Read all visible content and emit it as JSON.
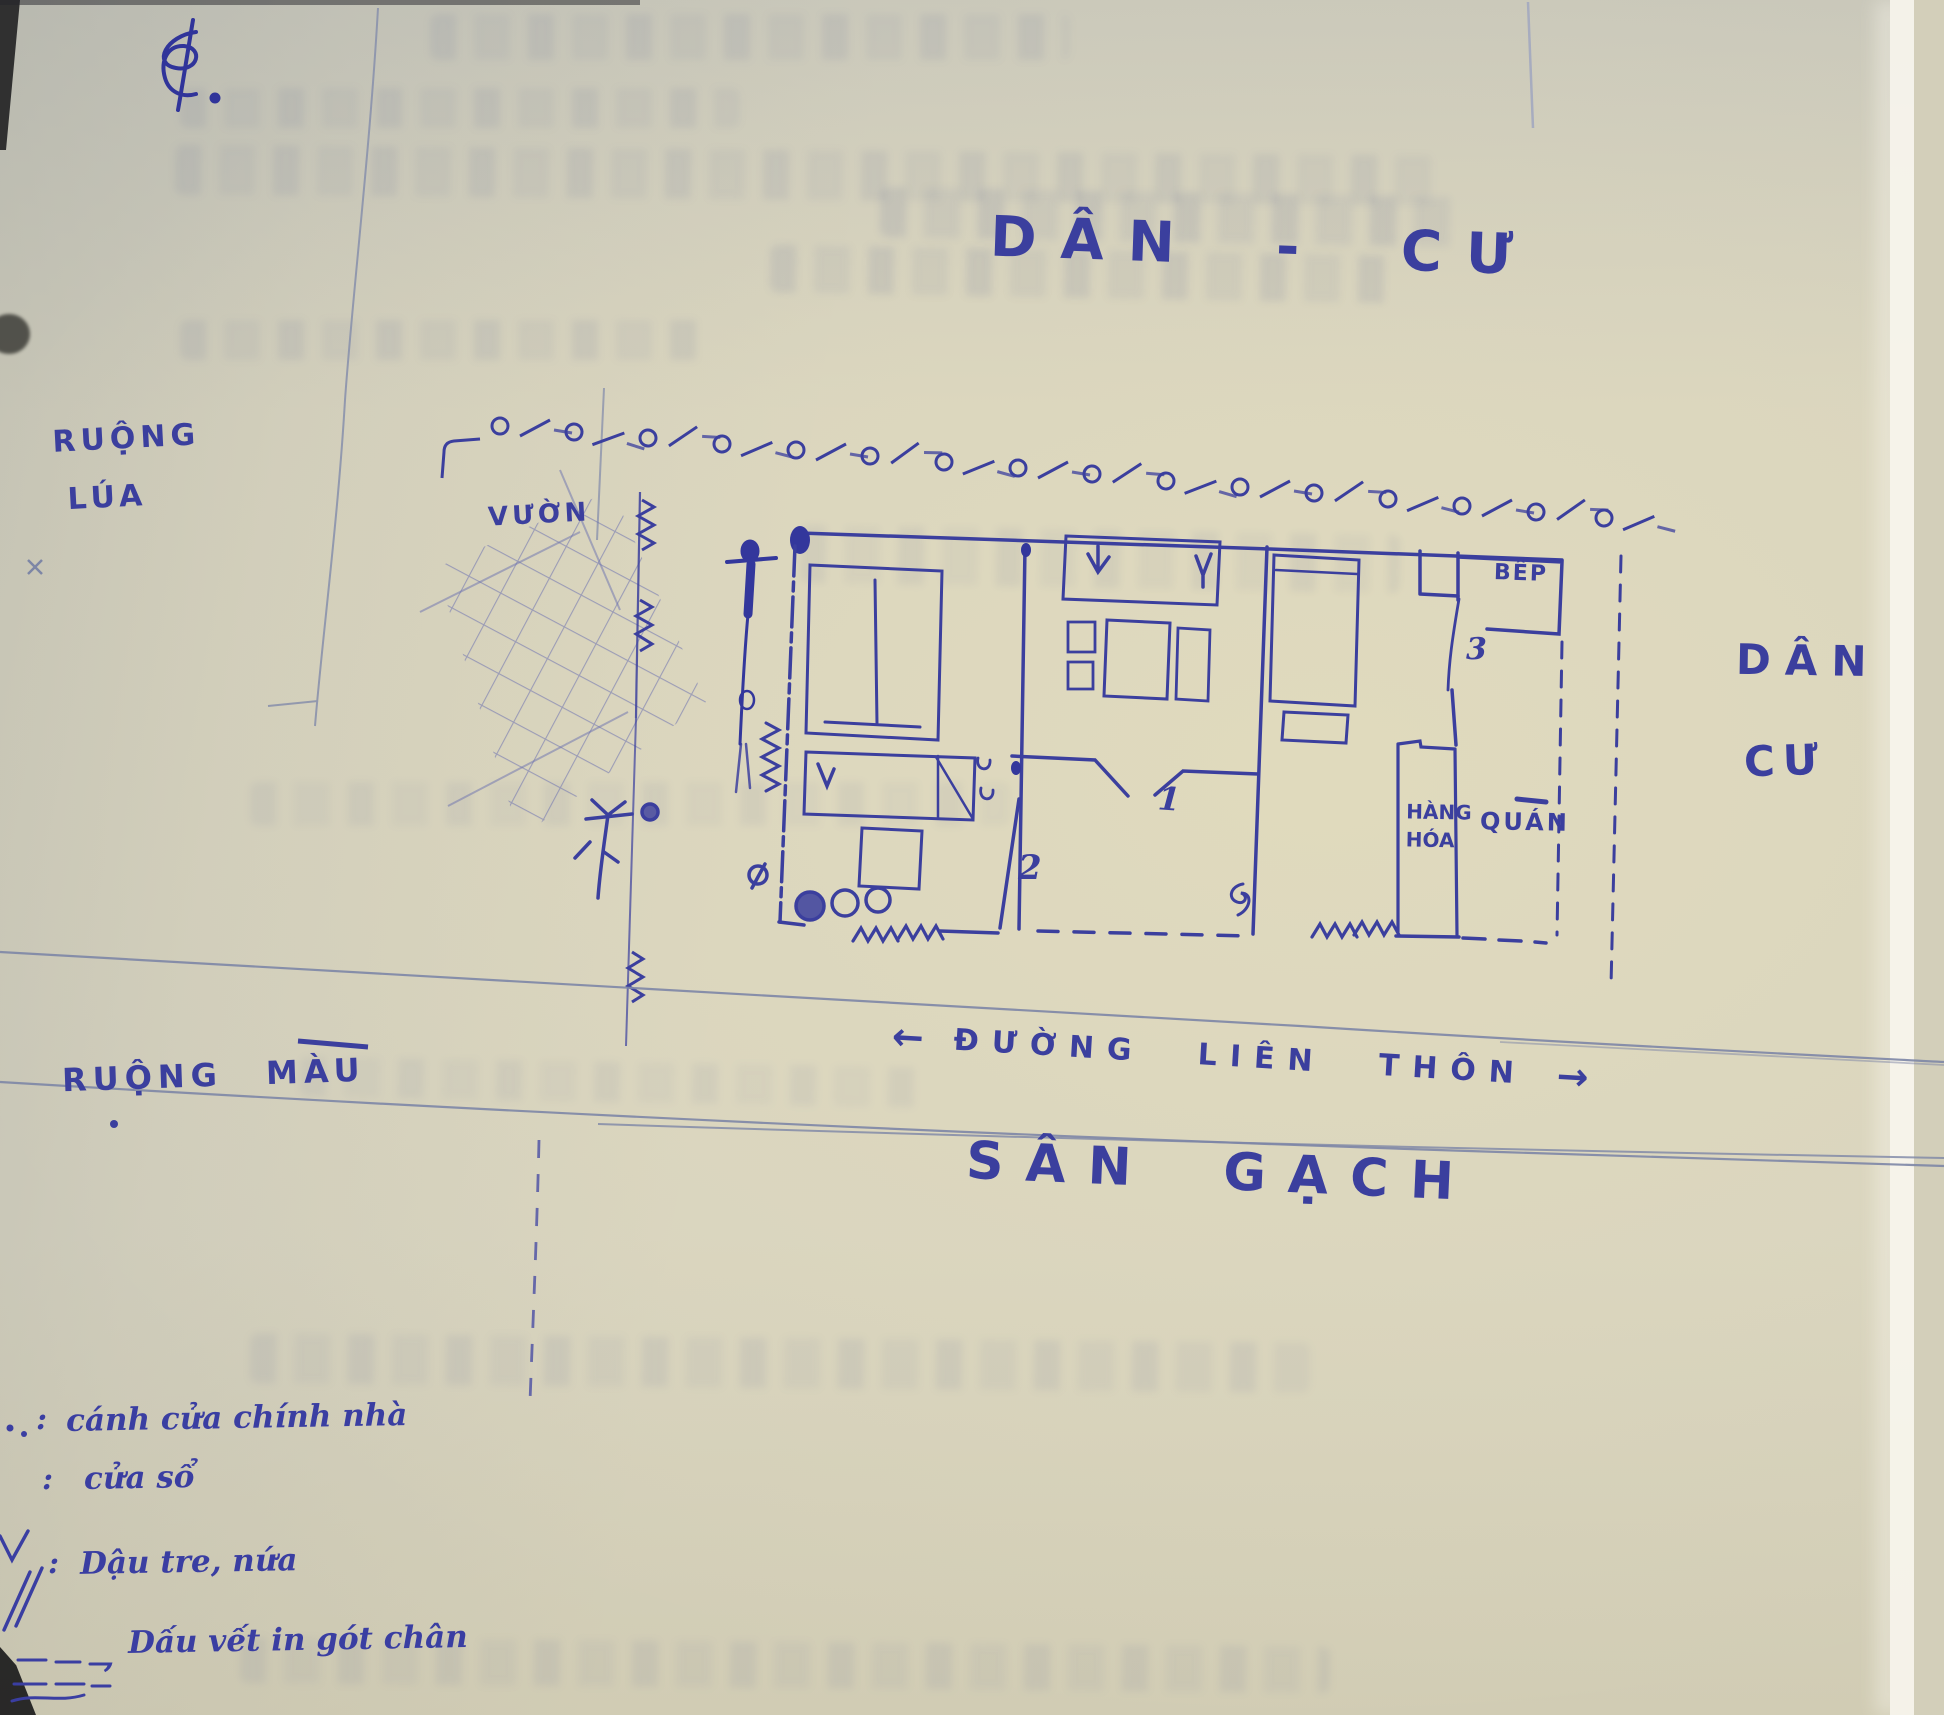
{
  "map": {
    "labels": {
      "top_residential": "DÂN - CƯ",
      "rice_field_1": "RUỘNG",
      "rice_field_2": "LÚA",
      "garden": "VƯỜN",
      "right_residential_1": "DÂN",
      "right_residential_2": "CƯ",
      "crop_field": "RUỘNG MÀU",
      "brick_yard": "SÂN GẠCH",
      "road": "ĐƯỜNG LIÊN THÔN",
      "road_arrow_left": "←",
      "road_arrow_right": "→",
      "kitchen": "BẾP",
      "goods_1": "HÀNG",
      "goods_2": "HÓA",
      "shop": "QUÁN",
      "marker_1": "1",
      "marker_2": "2",
      "marker_3": "3"
    },
    "colors": {
      "ink": "#3b3f9e",
      "paper": "#d7d3c0",
      "ruling": "#7d86a6"
    }
  },
  "legend": {
    "items": [
      {
        "separator": ":",
        "label": "cánh cửa chính nhà"
      },
      {
        "separator": ":",
        "label": "cửa sổ"
      },
      {
        "separator": ":",
        "label": "Dậu tre, nứa"
      },
      {
        "separator": ",",
        "label": "Dấu vết in gót chân"
      }
    ]
  }
}
